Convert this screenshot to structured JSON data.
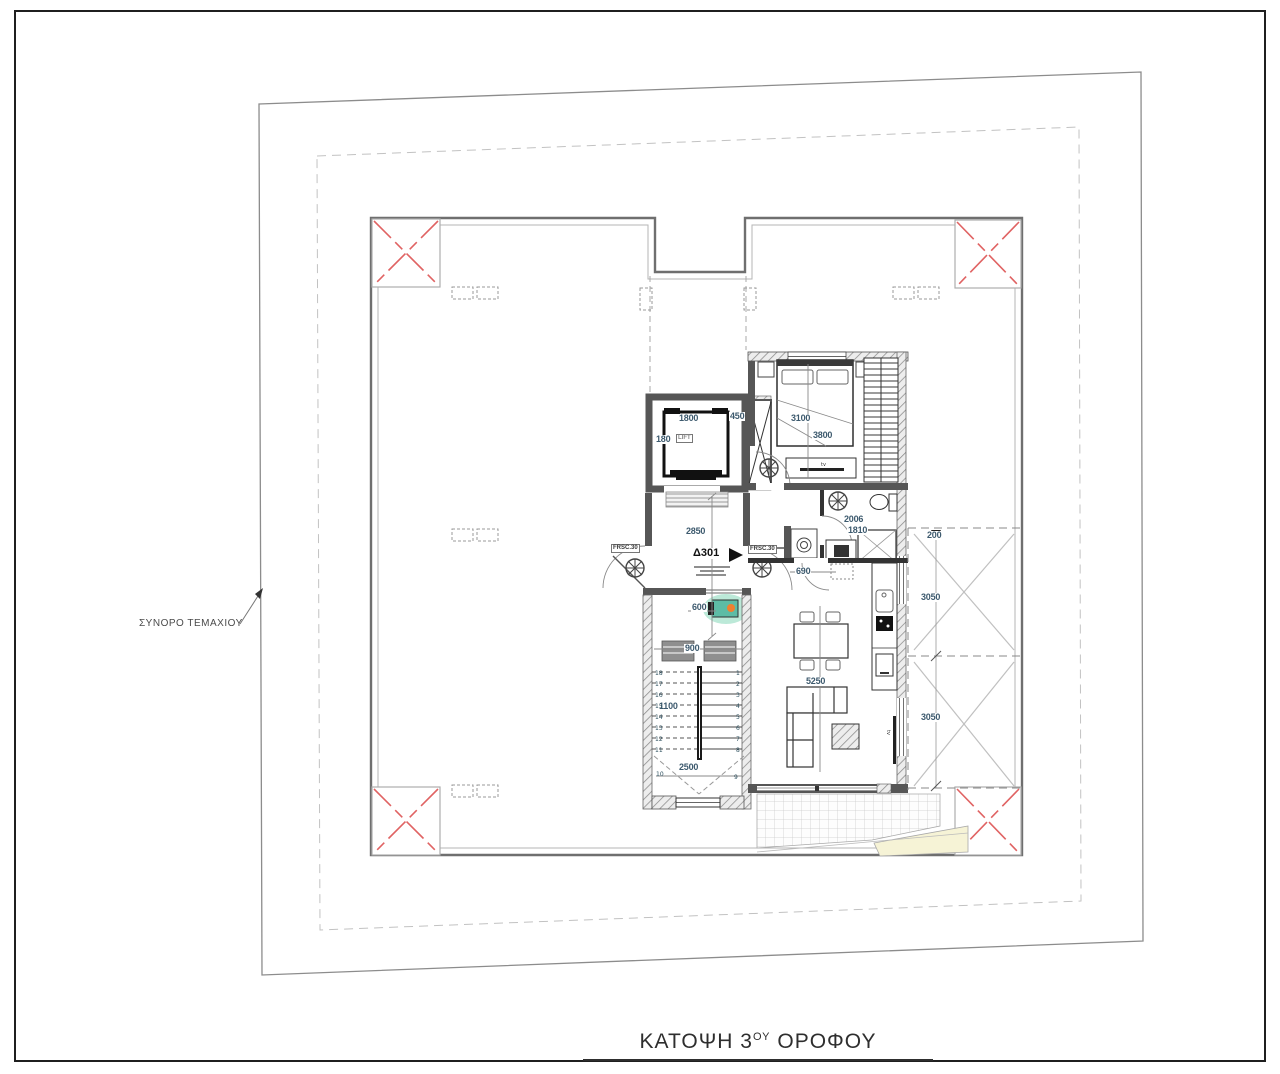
{
  "sheet": {
    "title_prefix": "ΚΑΤΟΨΗ 3",
    "title_superscript": "ΟΥ",
    "title_suffix": " ΟΡΟΦΟΥ"
  },
  "annotations": {
    "plot_boundary": "ΣΥΝΟΡΟ ΤΕΜΑΧΙΟΥ",
    "unit_number": "Δ301",
    "fire_door_left": "FRSC.30",
    "fire_door_right": "FRSC.30",
    "lift_label": "LIFT",
    "bedroom_tv": "tv",
    "living_tv": "tv"
  },
  "dimensions": {
    "lift_clear_width": "1800",
    "lift_cab": "180",
    "duct": "450",
    "lobby_depth": "2850",
    "landing_window": "600",
    "stair_width": "900",
    "stair_flight": "1100",
    "stair_length": "2500",
    "bedroom_width": "3100",
    "bedroom_depth": "3800",
    "bath_width": "2006",
    "bath_depth": "1810",
    "hall_door": "690",
    "living_depth": "5250",
    "veranda_offset": "200",
    "veranda_upper_width": "3050",
    "veranda_lower_width": "3050"
  },
  "stairs": {
    "left_numbers": [
      "18",
      "17",
      "16",
      "15",
      "14",
      "13",
      "12",
      "11"
    ],
    "right_numbers": [
      "1",
      "2",
      "3",
      "4",
      "5",
      "6",
      "7",
      "8"
    ],
    "turn_numbers": [
      "10",
      "9"
    ]
  },
  "colors": {
    "corner_marker_red": "#e06363",
    "highlight_teal": "#53b8a0",
    "highlight_orange": "#f08030",
    "planter_yellow": "#f6f3d6",
    "dimension_text": "#3d5a6e"
  }
}
